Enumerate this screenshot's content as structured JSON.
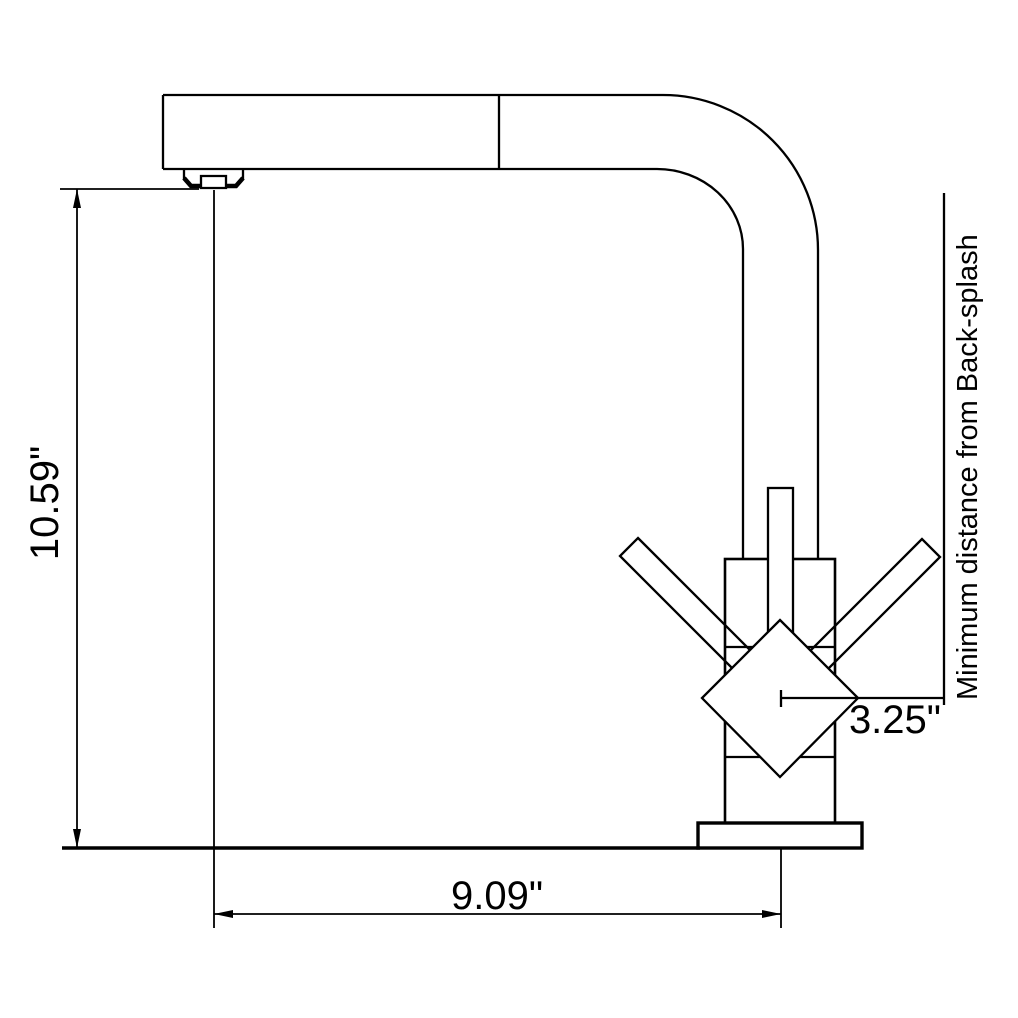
{
  "page": {
    "background_color": "#ffffff",
    "line_color": "#000000"
  },
  "diagram": {
    "subject": "kitchen-faucet-dimension-drawing",
    "labels": {
      "height": "10.59\"",
      "spout_reach": "9.09\"",
      "backsplash_offset": "3.25\"",
      "backsplash_note": "Minimum distance from Back-splash"
    }
  }
}
